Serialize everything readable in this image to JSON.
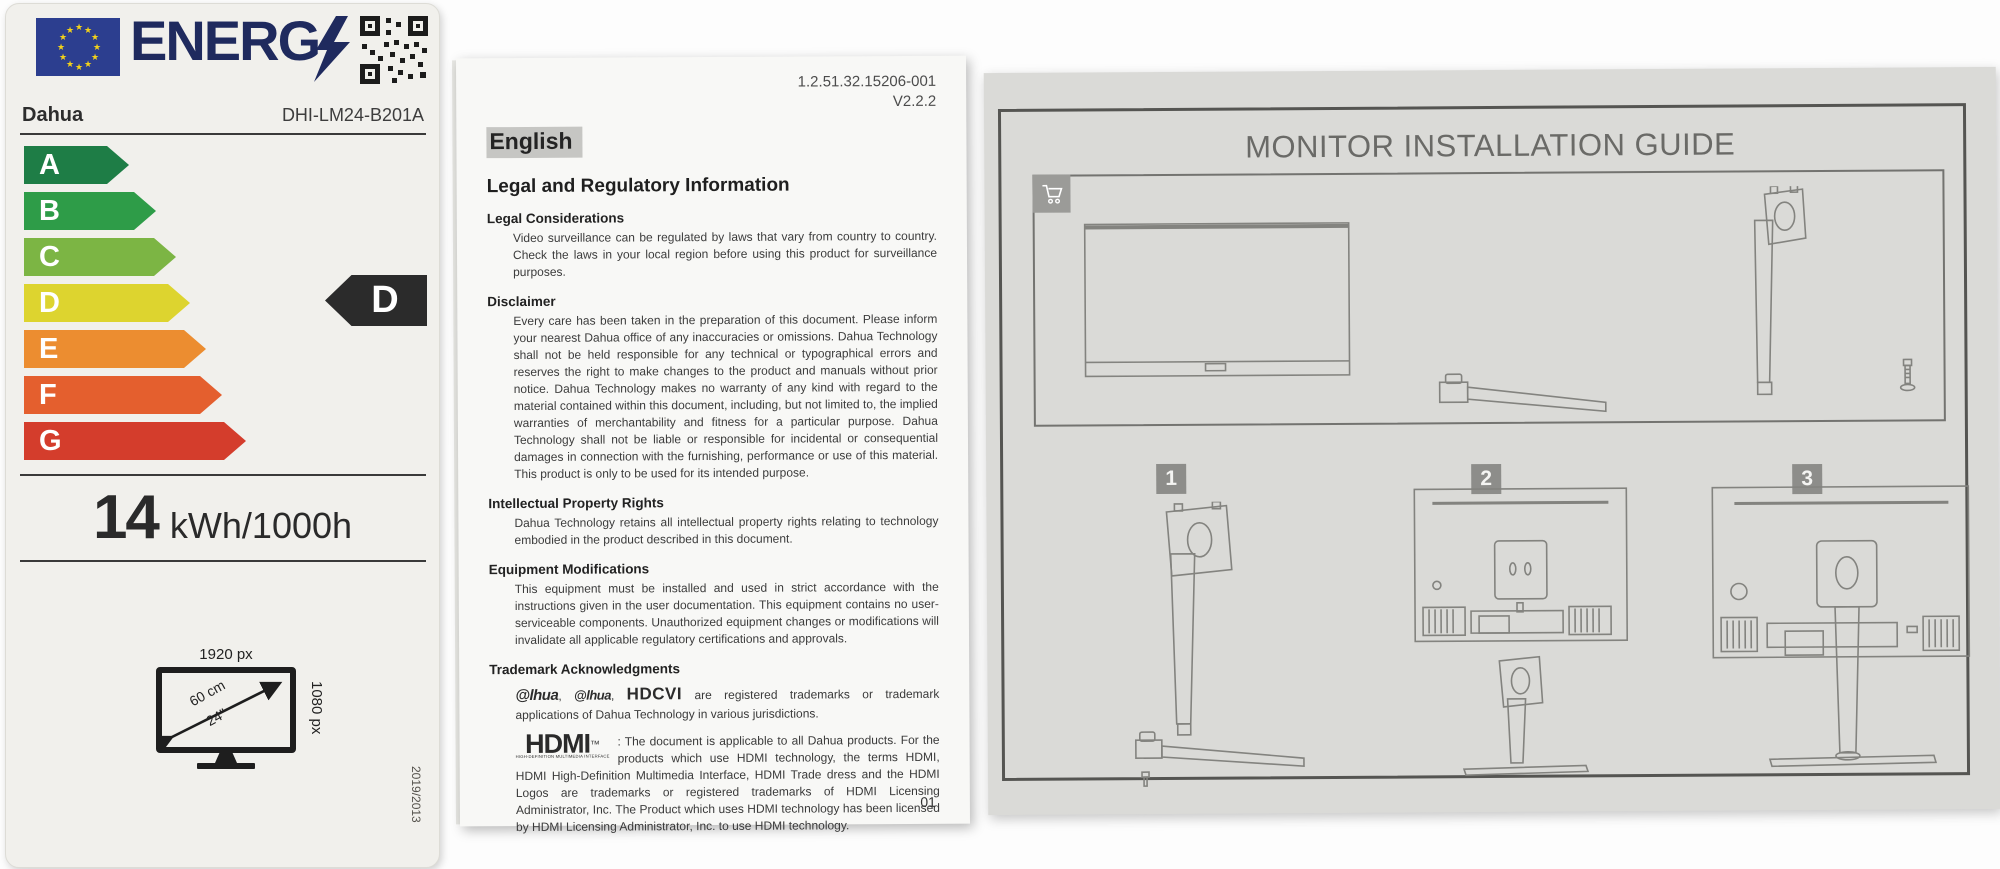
{
  "energy_label": {
    "wordmark": "ENERG",
    "supplier": "Dahua",
    "model": "DHI-LM24-B201A",
    "classes": [
      {
        "letter": "A",
        "color": "#1e7d46",
        "width": 105
      },
      {
        "letter": "B",
        "color": "#2e9c48",
        "width": 132
      },
      {
        "letter": "C",
        "color": "#7cb544",
        "width": 152
      },
      {
        "letter": "D",
        "color": "#ddd42f",
        "width": 166
      },
      {
        "letter": "E",
        "color": "#ec8d30",
        "width": 182
      },
      {
        "letter": "F",
        "color": "#e45f2e",
        "width": 198
      },
      {
        "letter": "G",
        "color": "#d43d2c",
        "width": 222
      }
    ],
    "rating": "D",
    "consumption_value": "14",
    "consumption_unit": "kWh/1000h",
    "resolution_horizontal": "1920 px",
    "resolution_vertical": "1080 px",
    "diagonal_cm": "60 cm",
    "diagonal_inch": "24\"",
    "regulation": "2019/2013"
  },
  "legal_doc": {
    "doc_number": "1.2.51.32.15206-001",
    "version": "V2.2.2",
    "language": "English",
    "title": "Legal and Regulatory Information",
    "sections": {
      "legal": {
        "heading": "Legal Considerations",
        "body": "Video surveillance can be regulated by laws that vary from country to country. Check the laws in your local region before using this product for surveillance purposes."
      },
      "disclaimer": {
        "heading": "Disclaimer",
        "body": "Every care has been taken in the preparation of this document. Please inform your nearest Dahua office of any inaccuracies or omissions. Dahua Technology shall not be held responsible for any technical or typographical errors and reserves the right to make changes to the product and manuals without prior notice. Dahua Technology makes no warranty of any kind with regard to the material contained within this document, including, but not limited to, the implied warranties of merchantability and fitness for a particular purpose. Dahua Technology shall not be liable or responsible for incidental or consequential damages in connection with the furnishing, performance or use of this material. This product is only to be used for its intended purpose."
      },
      "ipr": {
        "heading": "Intellectual Property Rights",
        "body": "Dahua Technology retains all intellectual property rights relating to technology embodied in the product described in this document."
      },
      "equipment": {
        "heading": "Equipment Modifications",
        "body": "This equipment must be installed and used in strict accordance with the instructions given in the user documentation. This equipment contains no user-serviceable components. Unauthorized equipment changes or modifications will invalidate all applicable regulatory certifications and approvals."
      },
      "trademark": {
        "heading": "Trademark Acknowledgments"
      }
    },
    "trademark_logos": {
      "dahua_large": "@lhua",
      "dahua_small": "@lhua",
      "hdcvi": "HDCVI"
    },
    "trademark_text": "are registered trademarks or trademark applications of Dahua Technology in various jurisdictions.",
    "hdmi_logo": "HDMI",
    "hdmi_logo_caption": "HIGH-DEFINITION MULTIMEDIA INTERFACE",
    "hdmi_text": ": The document is applicable to all Dahua products. For the products which use HDMI technology, the terms HDMI, HDMI High-Definition Multimedia Interface, HDMI Trade dress and the HDMI Logos are trademarks or registered trademarks of HDMI Licensing Administrator, Inc. The Product which uses HDMI technology has been licensed by HDMI Licensing Administrator, Inc. to use HDMI technology.",
    "page_number": "01"
  },
  "install_guide": {
    "title": "MONITOR INSTALLATION GUIDE",
    "steps": {
      "one": "1",
      "two": "2",
      "three": "3"
    }
  }
}
